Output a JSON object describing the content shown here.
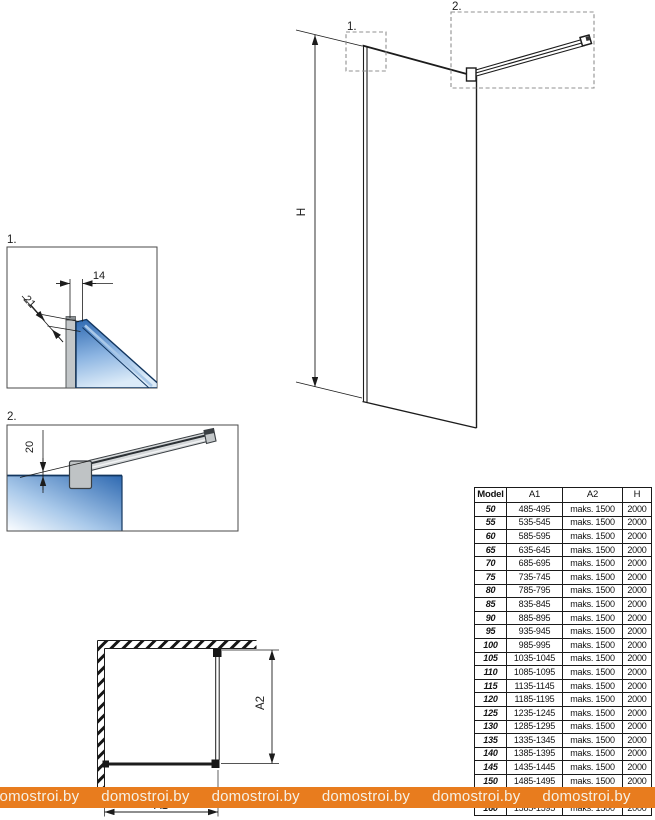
{
  "drawing": {
    "elevation": {
      "h_label": "H",
      "callout_1": "1.",
      "callout_2": "2."
    },
    "detail_1": {
      "label": "1.",
      "dim_profile_width": "14",
      "dim_profile_depth": "21"
    },
    "detail_2": {
      "label": "2.",
      "dim_bar_offset": "20"
    },
    "plan": {
      "a1_label": "A1",
      "a2_label": "A2"
    }
  },
  "spec_table": {
    "headers": [
      "Model",
      "A1",
      "A2",
      "H"
    ],
    "rows": [
      [
        "50",
        "485-495",
        "maks. 1500",
        "2000"
      ],
      [
        "55",
        "535-545",
        "maks. 1500",
        "2000"
      ],
      [
        "60",
        "585-595",
        "maks. 1500",
        "2000"
      ],
      [
        "65",
        "635-645",
        "maks. 1500",
        "2000"
      ],
      [
        "70",
        "685-695",
        "maks. 1500",
        "2000"
      ],
      [
        "75",
        "735-745",
        "maks. 1500",
        "2000"
      ],
      [
        "80",
        "785-795",
        "maks. 1500",
        "2000"
      ],
      [
        "85",
        "835-845",
        "maks. 1500",
        "2000"
      ],
      [
        "90",
        "885-895",
        "maks. 1500",
        "2000"
      ],
      [
        "95",
        "935-945",
        "maks. 1500",
        "2000"
      ],
      [
        "100",
        "985-995",
        "maks. 1500",
        "2000"
      ],
      [
        "105",
        "1035-1045",
        "maks. 1500",
        "2000"
      ],
      [
        "110",
        "1085-1095",
        "maks. 1500",
        "2000"
      ],
      [
        "115",
        "1135-1145",
        "maks. 1500",
        "2000"
      ],
      [
        "120",
        "1185-1195",
        "maks. 1500",
        "2000"
      ],
      [
        "125",
        "1235-1245",
        "maks. 1500",
        "2000"
      ],
      [
        "130",
        "1285-1295",
        "maks. 1500",
        "2000"
      ],
      [
        "135",
        "1335-1345",
        "maks. 1500",
        "2000"
      ],
      [
        "140",
        "1385-1395",
        "maks. 1500",
        "2000"
      ],
      [
        "145",
        "1435-1445",
        "maks. 1500",
        "2000"
      ],
      [
        "150",
        "1485-1495",
        "maks. 1500",
        "2000"
      ],
      [
        "155",
        "1535-1545",
        "maks. 1500",
        "2000"
      ],
      [
        "160",
        "1585-1595",
        "maks. 1500",
        "2000"
      ]
    ]
  },
  "watermark": {
    "text": "domostroi.by",
    "repeat": 6,
    "bar_color": "#e87c1e",
    "text_color": "#f6f0e4"
  },
  "colors": {
    "line": "#1c1c1c",
    "callout_dash": "#909090",
    "glass_dark": "#2e69b1",
    "glass_light": "#e9f2fb",
    "glass_edge": "#12365f",
    "metal_gray": "#c3c7c9",
    "metal_dark": "#3a3f43"
  }
}
